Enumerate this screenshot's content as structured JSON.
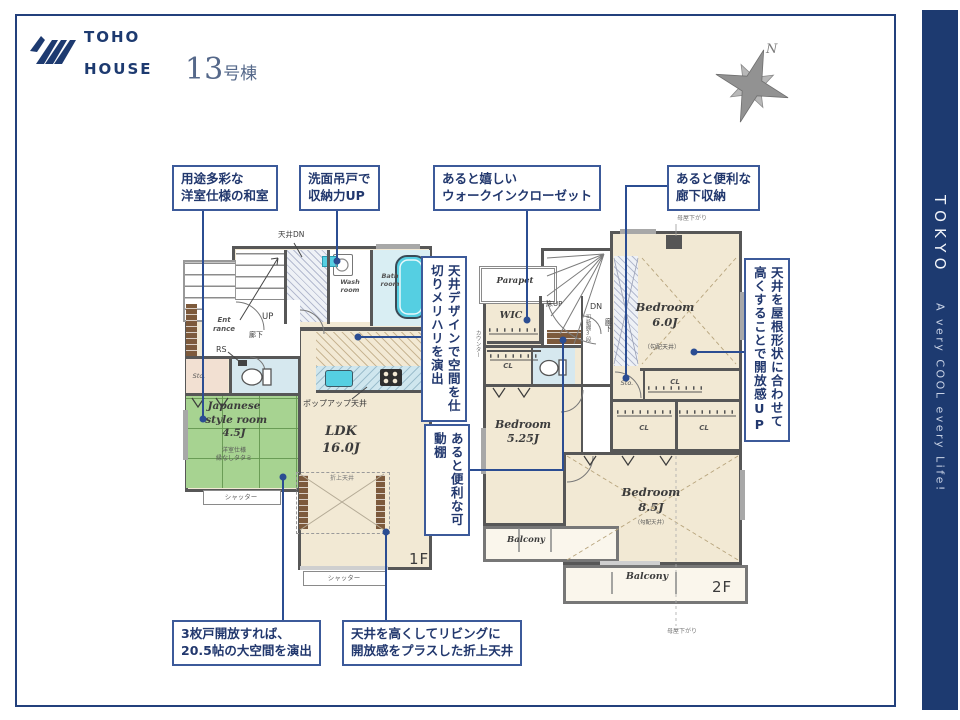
{
  "brand": {
    "logo_line1": "TOHO",
    "logo_line2": "HOUSE"
  },
  "title": {
    "number": "13",
    "suffix": "号棟"
  },
  "compass": {
    "north": "N"
  },
  "sidebar": {
    "word": "TOKYO",
    "tagline": "A very COOL every Life!"
  },
  "colors": {
    "accent_navy": "#1d3a70",
    "callout_border": "#3c5a9a",
    "connector": "#2b4d92",
    "wall": "#575757",
    "floor": "#f2e9d4",
    "tatami": "#a7d391",
    "water": "#55cfe2",
    "tile": "#d7ecf2"
  },
  "callouts": {
    "tatami": "用途多彩な\n洋室仕様の和室",
    "wash": "洗面吊戸で\n収納力UP",
    "wic": "あると嬉しい\nウォークインクローゼット",
    "hall_storage": "あると便利な\n廊下収納",
    "three_doors": "3枚戸開放すれば、\n20.5帖の大空間を演出",
    "coved": "天井を高くしてリビングに\n開放感をプラスした折上天井",
    "ceiling_design": "天井デザインで空間を仕切りメリハリを演出",
    "shelf": "あると便利な可動棚",
    "sloped": "天井を屋根形状に合わせて高くすることで開放感UP"
  },
  "floor1": {
    "tag": "1F",
    "ldk": "LDK",
    "ldk_size": "16.0J",
    "jp_room": "Japanese\n-style room",
    "jp_size": "4.5J",
    "jp_note": "洋室仕様\n縁なしタタミ",
    "wash_room": "Wash\nroom",
    "bath_room": "Bath\nroom",
    "entrance": "Ent\nrance",
    "up": "UP",
    "hall": "廊下",
    "rs": "RS",
    "sto": "Sto.",
    "ceiling_dn": "天井DN",
    "popup": "ポップアップ天井",
    "oriage": "折上天井",
    "shutter": "シャッター"
  },
  "floor2": {
    "tag": "2F",
    "parapet": "Parapet",
    "wic": "WIC",
    "floor_up": "床UP",
    "dn": "DN",
    "hall": "廊下",
    "shelf_note": "可動棚3段",
    "sto": "Sto.",
    "cl": "CL",
    "counter": "カウンター",
    "bedroom": "Bedroom",
    "bed6_size": "6.0J",
    "bed6_note": "（勾配天井）",
    "bed5_size": "5.25J",
    "bed8_size": "8.5J",
    "bed8_note": "（勾配天井）",
    "balcony": "Balcony",
    "moya": "母屋下がり"
  }
}
